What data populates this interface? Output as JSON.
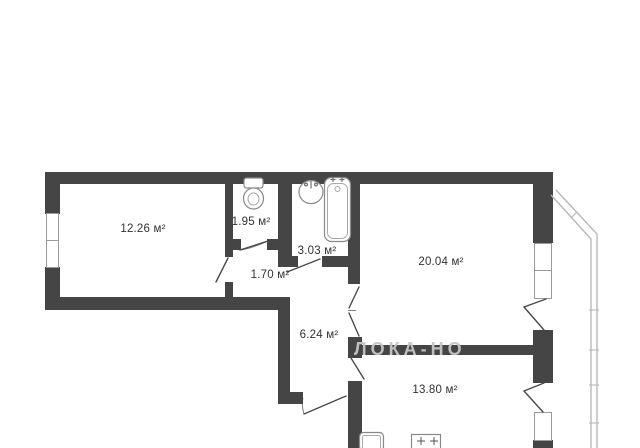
{
  "plan": {
    "rooms": [
      {
        "id": "room-main",
        "area_label": "12.26 м²"
      },
      {
        "id": "wc",
        "area_label": "1.95 м²"
      },
      {
        "id": "bathroom",
        "area_label": "3.03 м²"
      },
      {
        "id": "hall",
        "area_label": "1.70 м²"
      },
      {
        "id": "living",
        "area_label": "20.04 м²"
      },
      {
        "id": "corridor",
        "area_label": "6.24 м²"
      },
      {
        "id": "kitchen",
        "area_label": "13.80 м²"
      }
    ],
    "watermark": "ЛОКА-НО",
    "colors": {
      "background": "#ffffff",
      "wall": "#454545",
      "door_line": "#4a4a4a",
      "window_line": "#9a9a9a",
      "balcony_line": "#b8b8b8",
      "fixture_stroke": "#8a8a8a",
      "label_text": "#333333",
      "watermark_text": "#c6c6c6"
    }
  }
}
